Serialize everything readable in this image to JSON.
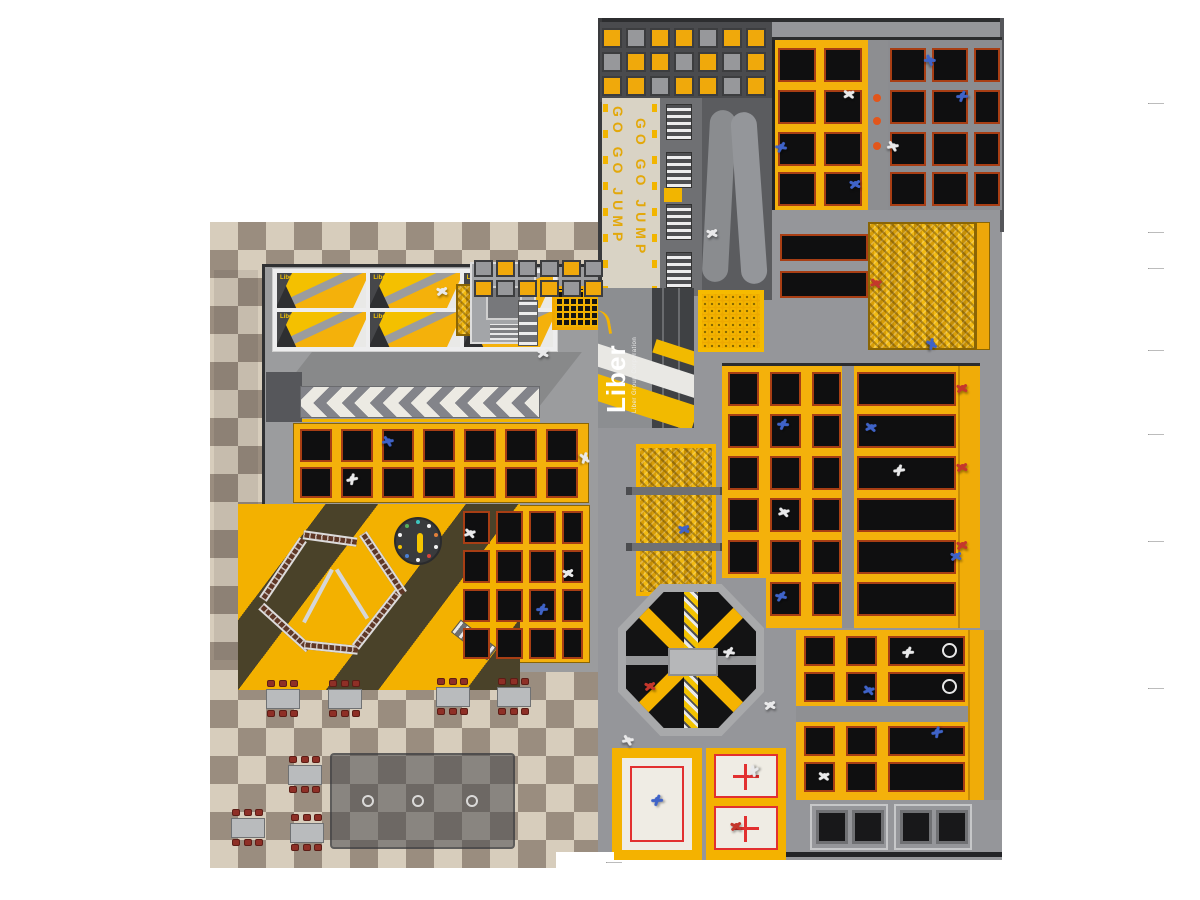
{
  "texts": {
    "banner_line": "GO  GO  JUMP",
    "logo": "Liber",
    "logo_sub": "Liber Group Corporation",
    "ninja_label": "Liber"
  },
  "colors": {
    "frame_yellow": "#f4b10b",
    "trampoline_black": "#0f0f10",
    "pad_red": "#a83e14",
    "floor_gray": "#95969a",
    "checker_light": "#d7cdbc",
    "checker_dark": "#9a8d7f",
    "foam_yellow": "#e3a90c",
    "ball_orange": "#e2561b",
    "chair_red": "#8e2f26"
  },
  "panels": [
    {
      "x": 602,
      "y": 28,
      "cw": 20,
      "ch": 20,
      "gap": 4,
      "rows": [
        "YGYYGYY",
        "GYYGYGY",
        "YYGYYGY"
      ]
    },
    {
      "x": 474,
      "y": 260,
      "cw": 19,
      "ch": 17,
      "gap": 3,
      "rows": [
        "GYGGYG",
        "YGYYGY"
      ]
    }
  ],
  "courts": {
    "topYellow": {
      "cols": [
        [
          778,
          38
        ],
        [
          824,
          38
        ]
      ],
      "rows": [
        [
          48,
          34
        ],
        [
          90,
          34
        ],
        [
          132,
          34
        ],
        [
          172,
          34
        ]
      ]
    },
    "topGray": {
      "cols": [
        [
          890,
          36
        ],
        [
          932,
          36
        ],
        [
          974,
          26
        ]
      ],
      "rows": [
        [
          48,
          34
        ],
        [
          90,
          34
        ],
        [
          132,
          34
        ],
        [
          172,
          34
        ]
      ]
    },
    "lanes": {
      "cols": [
        [
          780,
          88
        ]
      ],
      "rows": [
        [
          234,
          27
        ],
        [
          271,
          27
        ]
      ]
    },
    "courtA": {
      "cols": [
        [
          300,
          32
        ],
        [
          341,
          32
        ],
        [
          382,
          32
        ],
        [
          423,
          32
        ],
        [
          464,
          32
        ],
        [
          505,
          32
        ],
        [
          546,
          32
        ]
      ],
      "rows": [
        [
          429,
          33
        ],
        [
          467,
          31
        ]
      ]
    },
    "courtB": {
      "cols": [
        [
          463,
          27
        ],
        [
          496,
          27
        ],
        [
          529,
          27
        ],
        [
          562,
          21
        ]
      ],
      "rows": [
        [
          511,
          33
        ],
        [
          550,
          33
        ],
        [
          589,
          33
        ],
        [
          628,
          31
        ]
      ]
    },
    "main": {
      "cols": [
        [
          728,
          31
        ],
        [
          770,
          31
        ],
        [
          812,
          29
        ],
        [
          857,
          99
        ]
      ],
      "rows": [
        [
          372,
          34
        ],
        [
          414,
          34
        ],
        [
          456,
          34
        ],
        [
          498,
          34
        ],
        [
          540,
          34
        ],
        [
          582,
          34
        ]
      ],
      "skip": [
        [
          5,
          0
        ]
      ]
    },
    "dunk": {
      "cols": [
        [
          804,
          31
        ],
        [
          846,
          31
        ],
        [
          888,
          77
        ]
      ],
      "rows": [
        [
          636,
          30
        ],
        [
          672,
          30
        ],
        [
          726,
          30
        ],
        [
          762,
          30
        ]
      ]
    }
  },
  "hoops": [
    [
      950,
      651
    ],
    [
      950,
      687
    ]
  ],
  "balls": [
    [
      877,
      98
    ],
    [
      877,
      121
    ],
    [
      877,
      146
    ]
  ],
  "rings": [
    [
      368,
      801
    ],
    [
      418,
      801
    ],
    [
      472,
      801
    ]
  ],
  "tables": [
    [
      283,
      699
    ],
    [
      345,
      699
    ],
    [
      453,
      697
    ],
    [
      514,
      697
    ],
    [
      305,
      775
    ],
    [
      248,
      828
    ],
    [
      307,
      833
    ]
  ],
  "ropes": [
    [
      330,
      540,
      54,
      8,
      "p"
    ],
    [
      283,
      571,
      72,
      -56,
      "p"
    ],
    [
      285,
      629,
      64,
      42,
      "p"
    ],
    [
      331,
      649,
      54,
      6,
      "p"
    ],
    [
      377,
      621,
      70,
      -52,
      "p"
    ],
    [
      383,
      565,
      72,
      56,
      "p"
    ],
    [
      318,
      596,
      60,
      -62,
      "r"
    ],
    [
      352,
      594,
      58,
      58,
      "r"
    ],
    [
      474,
      641,
      46,
      38,
      "ld"
    ]
  ],
  "clock": {
    "cx": 418,
    "cy": 541,
    "r": 19,
    "dots": [
      "#3ec6c0",
      "#f2f2f2",
      "#e2803a",
      "#f2f2f2",
      "#d8453a",
      "#f2f2f2",
      "#4a7fd4",
      "#f5c400",
      "#f2f2f2",
      "#59b05a"
    ]
  },
  "people": [
    [
      930,
      60,
      "b",
      40
    ],
    [
      962,
      96,
      "b",
      -30
    ],
    [
      849,
      94,
      "w",
      10
    ],
    [
      781,
      147,
      "b",
      -20
    ],
    [
      893,
      146,
      "w",
      30
    ],
    [
      855,
      184,
      "b",
      0
    ],
    [
      712,
      233,
      "w",
      0
    ],
    [
      442,
      291,
      "w",
      0
    ],
    [
      876,
      283,
      "r",
      20
    ],
    [
      543,
      353,
      "w",
      0
    ],
    [
      932,
      344,
      "b",
      70
    ],
    [
      388,
      441,
      "b",
      30
    ],
    [
      352,
      479,
      "w",
      -40
    ],
    [
      470,
      533,
      "w",
      20
    ],
    [
      568,
      573,
      "w",
      0
    ],
    [
      542,
      609,
      "b",
      -30
    ],
    [
      585,
      458,
      "w",
      80
    ],
    [
      684,
      529,
      "b",
      0
    ],
    [
      783,
      424,
      "b",
      -25
    ],
    [
      871,
      427,
      "b",
      15
    ],
    [
      899,
      470,
      "w",
      -35
    ],
    [
      784,
      512,
      "w",
      20
    ],
    [
      956,
      556,
      "b",
      0
    ],
    [
      781,
      596,
      "b",
      -15
    ],
    [
      962,
      388,
      "r",
      0
    ],
    [
      962,
      467,
      "r",
      0
    ],
    [
      962,
      545,
      "r",
      0
    ],
    [
      650,
      686,
      "r",
      0
    ],
    [
      729,
      652,
      "w",
      -20
    ],
    [
      770,
      705,
      "w",
      0
    ],
    [
      628,
      740,
      "w",
      30
    ],
    [
      908,
      652,
      "w",
      -30
    ],
    [
      869,
      690,
      "b",
      20
    ],
    [
      937,
      732,
      "b",
      -40
    ],
    [
      824,
      776,
      "w",
      10
    ],
    [
      657,
      800,
      "b",
      -30
    ],
    [
      753,
      771,
      "w",
      -60
    ],
    [
      736,
      826,
      "r",
      0
    ]
  ],
  "ticks": [
    [
      1148,
      103
    ],
    [
      1148,
      232
    ],
    [
      1148,
      268
    ],
    [
      1148,
      350
    ],
    [
      1148,
      434
    ],
    [
      1148,
      541
    ],
    [
      1148,
      688
    ],
    [
      606,
      862
    ]
  ]
}
